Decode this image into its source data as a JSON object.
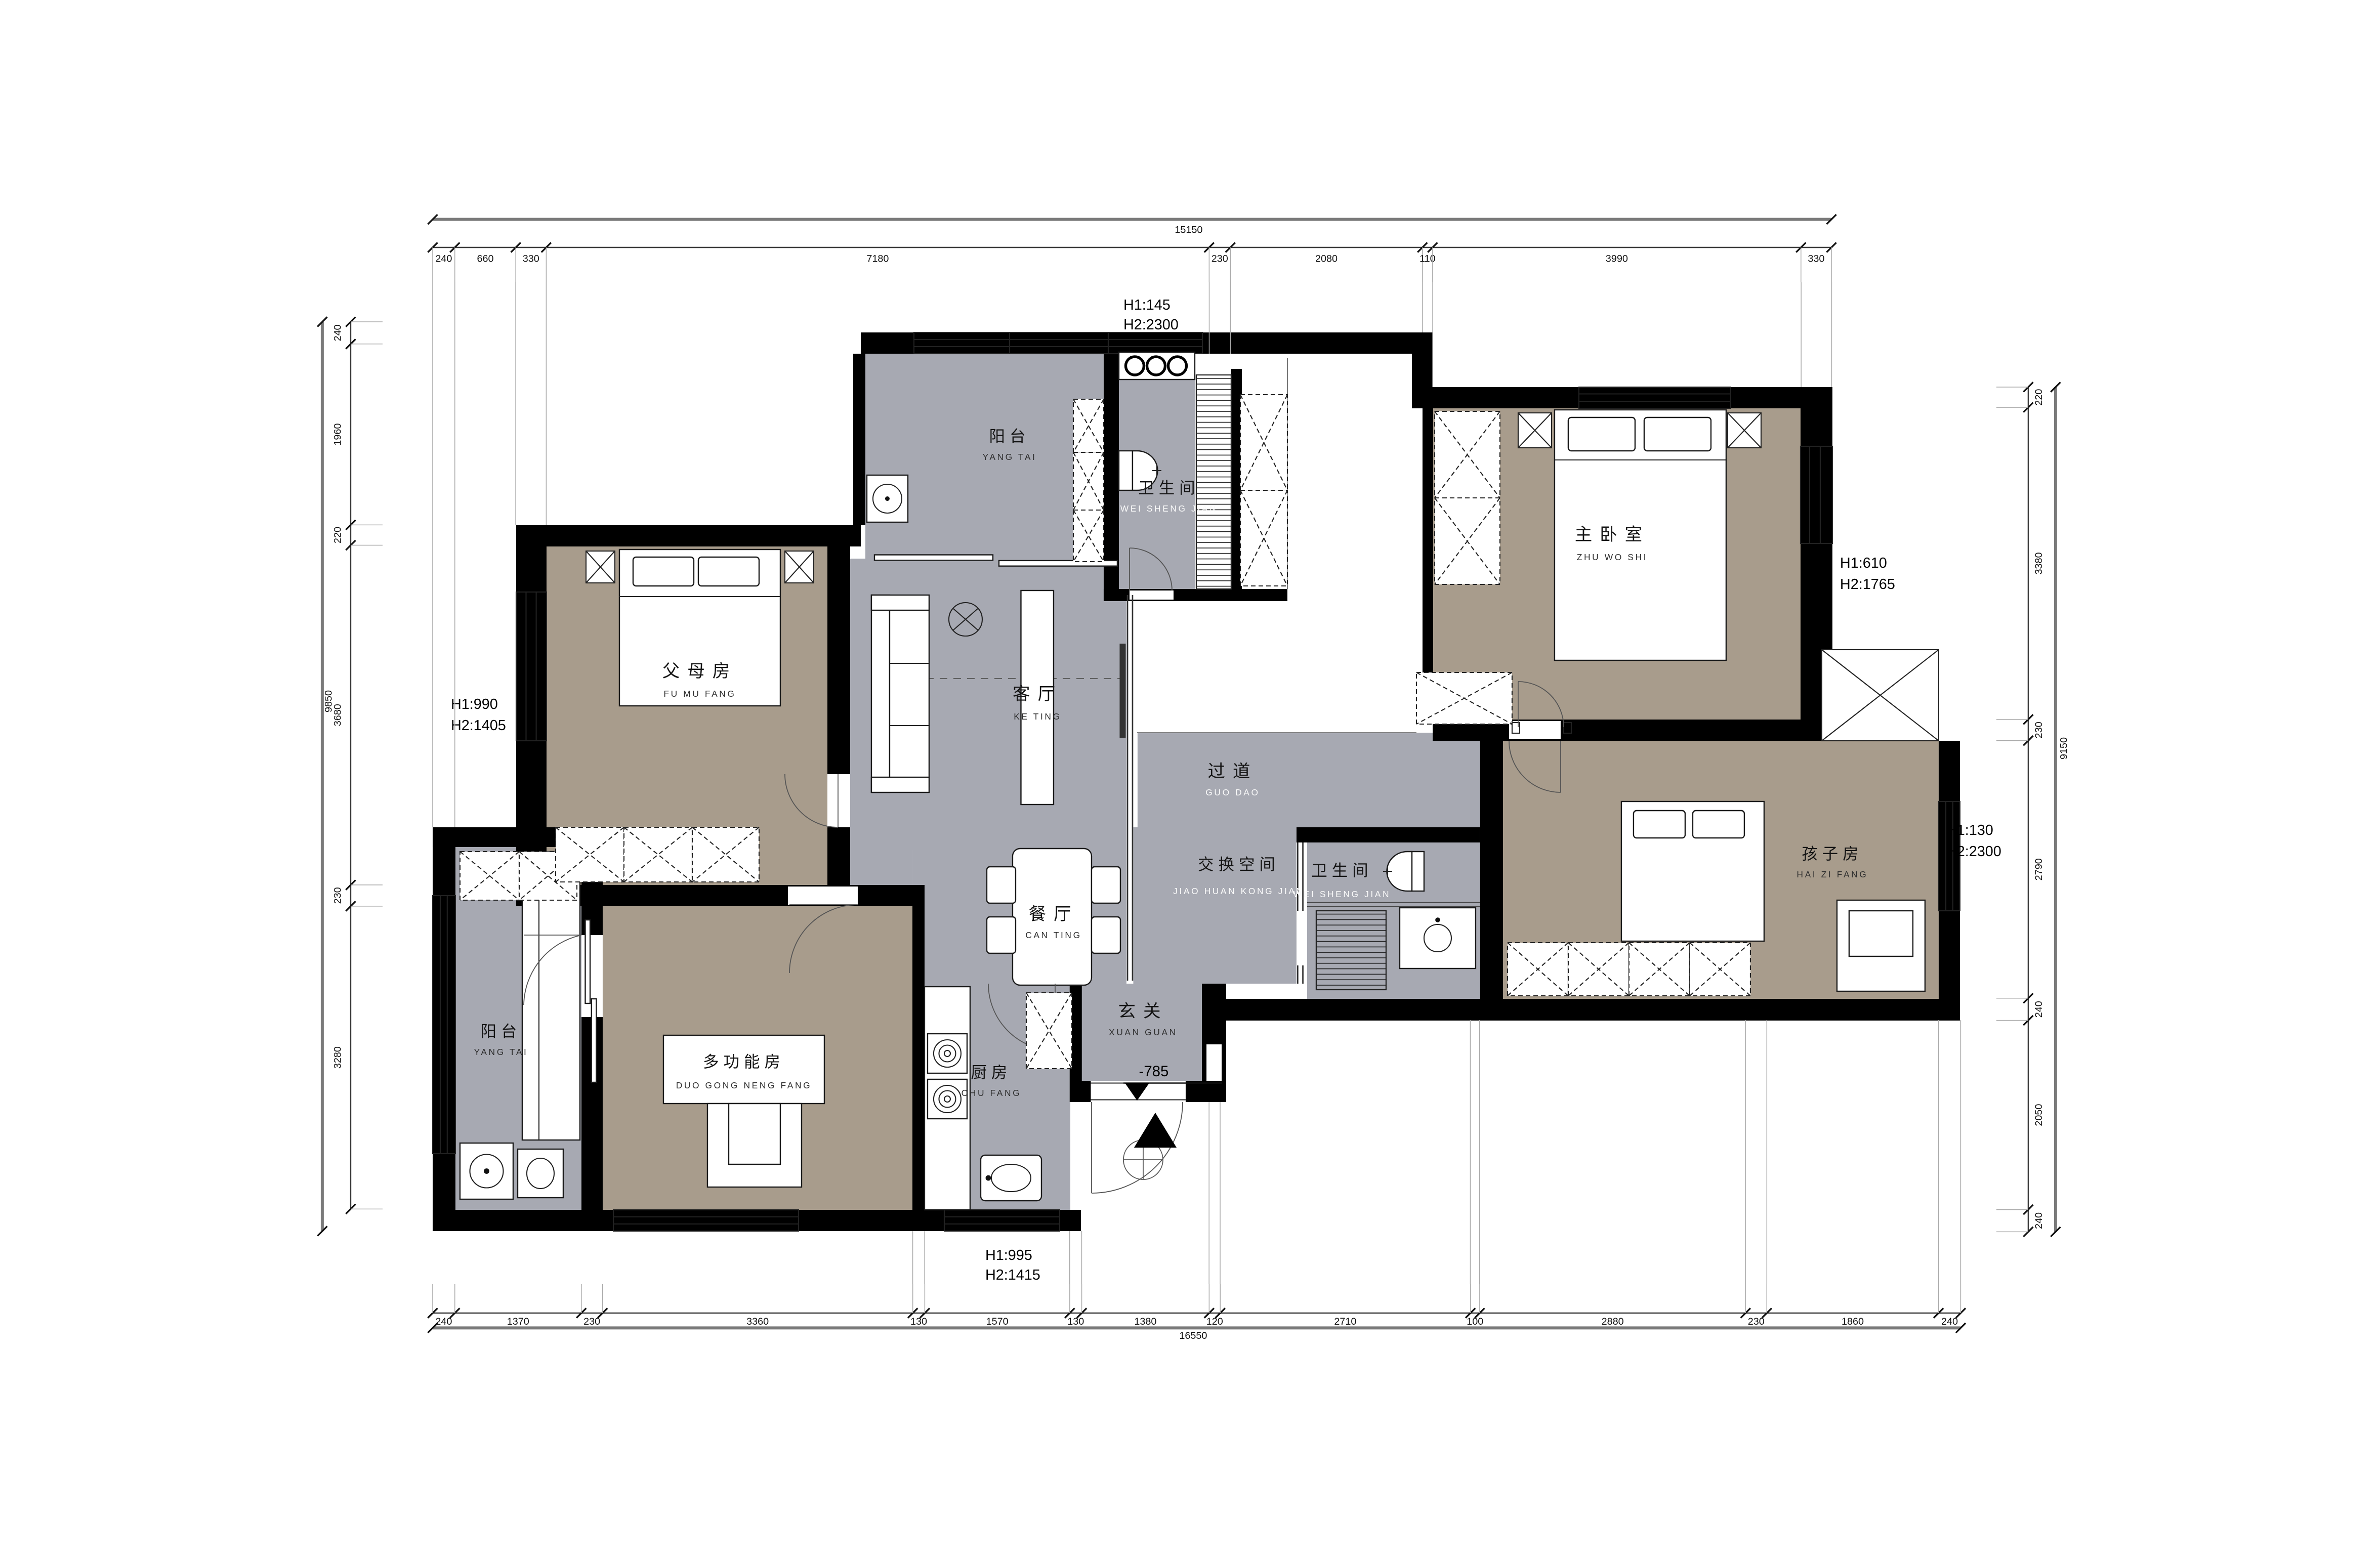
{
  "colors": {
    "floor_gray": "#a7a9b2",
    "floor_tan": "#a89c8c",
    "wall": "#000000",
    "dim_line": "#3a3a3a",
    "total_line": "#7a7a7a"
  },
  "rooms": {
    "yangtai_top": {
      "name": "阳台",
      "pinyin": "YANG TAI"
    },
    "weishengjian_top": {
      "name": "卫生间",
      "pinyin": "WEI SHENG JIAN"
    },
    "zhuwoshi": {
      "name": "主卧室",
      "pinyin": "ZHU WO SHI"
    },
    "fumufang": {
      "name": "父母房",
      "pinyin": "FU MU FANG"
    },
    "keting": {
      "name": "客厅",
      "pinyin": "KE TING"
    },
    "guodao": {
      "name": "过道",
      "pinyin": "GUO DAO"
    },
    "jiaohuan": {
      "name": "交换空间",
      "pinyin": "JIAO HUAN KONG JIAN"
    },
    "weishengjian_2": {
      "name": "卫生间",
      "pinyin": "WEI SHENG JIAN"
    },
    "haizifang": {
      "name": "孩子房",
      "pinyin": "HAI ZI FANG"
    },
    "canting": {
      "name": "餐厅",
      "pinyin": "CAN TING"
    },
    "xuanguan": {
      "name": "玄关",
      "pinyin": "XUAN GUAN"
    },
    "duogongnengfang": {
      "name": "多功能房",
      "pinyin": "DUO GONG NENG FANG"
    },
    "yangtai_left": {
      "name": "阳台",
      "pinyin": "YANG TAI"
    },
    "chufang": {
      "name": "厨房",
      "pinyin": "CHU FANG"
    }
  },
  "annotations": {
    "top": {
      "h1": "H1:145",
      "h2": "H2:2300"
    },
    "left": {
      "h1": "H1:990",
      "h2": "H2:1405"
    },
    "right_upper": {
      "h1": "H1:610",
      "h2": "H2:1765"
    },
    "right_mid": {
      "h1": "H1:130",
      "h2": "H2:2300"
    },
    "bottom": {
      "h1": "H1:995",
      "h2": "H2:1415"
    },
    "level": "-785"
  },
  "dims": {
    "top": {
      "segments": [
        "240",
        "660",
        "330",
        "7180",
        "230",
        "2080",
        "110",
        "3990",
        "330"
      ],
      "total": "15150"
    },
    "bottom": {
      "segments": [
        "240",
        "1370",
        "230",
        "3360",
        "130",
        "1570",
        "130",
        "1380",
        "120",
        "2710",
        "100",
        "2880",
        "230",
        "1860",
        "240"
      ],
      "total": "16550"
    },
    "left": {
      "segments": [
        "240",
        "1960",
        "220",
        "3680",
        "230",
        "3280"
      ],
      "total": "9850"
    },
    "right": {
      "segments": [
        "220",
        "3380",
        "230",
        "2790",
        "240",
        "2050",
        "240"
      ],
      "total": "9150"
    }
  }
}
